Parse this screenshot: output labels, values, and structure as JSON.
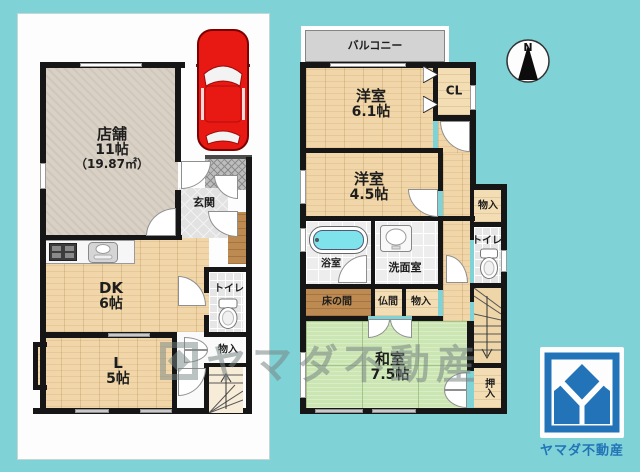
{
  "floor1": {
    "shop": "店舗",
    "shop_size": "11帖",
    "shop_area": "（19.87㎡）",
    "genkan": "玄関",
    "dk": "DK",
    "dk_size": "6帖",
    "living": "L",
    "living_size": "5帖",
    "toilet": "トイレ",
    "storage": "物入"
  },
  "floor2": {
    "balcony": "バルコニー",
    "bedroom1": "洋室",
    "bedroom1_size": "6.1帖",
    "closet": "CL",
    "bedroom2": "洋室",
    "bedroom2_size": "4.5帖",
    "storage_upper": "物入",
    "toilet": "トイレ",
    "bath": "浴室",
    "washroom": "洗面室",
    "tokonoma": "床の間",
    "butsuma": "仏間",
    "storage_lower": "物入",
    "washitsu": "和室",
    "washitsu_size": "7.5帖",
    "oshiire": "押入"
  },
  "compass": {
    "label": "N"
  },
  "watermark": {
    "text": "ヤマダ不動産"
  },
  "logo": {
    "company": "ヤマダ不動産"
  },
  "colors": {
    "background": "#7fd2d6",
    "wall": "#161616",
    "wood_floor": "#f0d6a8",
    "tatami_green": "#cbe6b2",
    "logo_blue": "#2273b8",
    "car_red": "#e81812",
    "bathtub_cyan": "#7fe3ec"
  }
}
